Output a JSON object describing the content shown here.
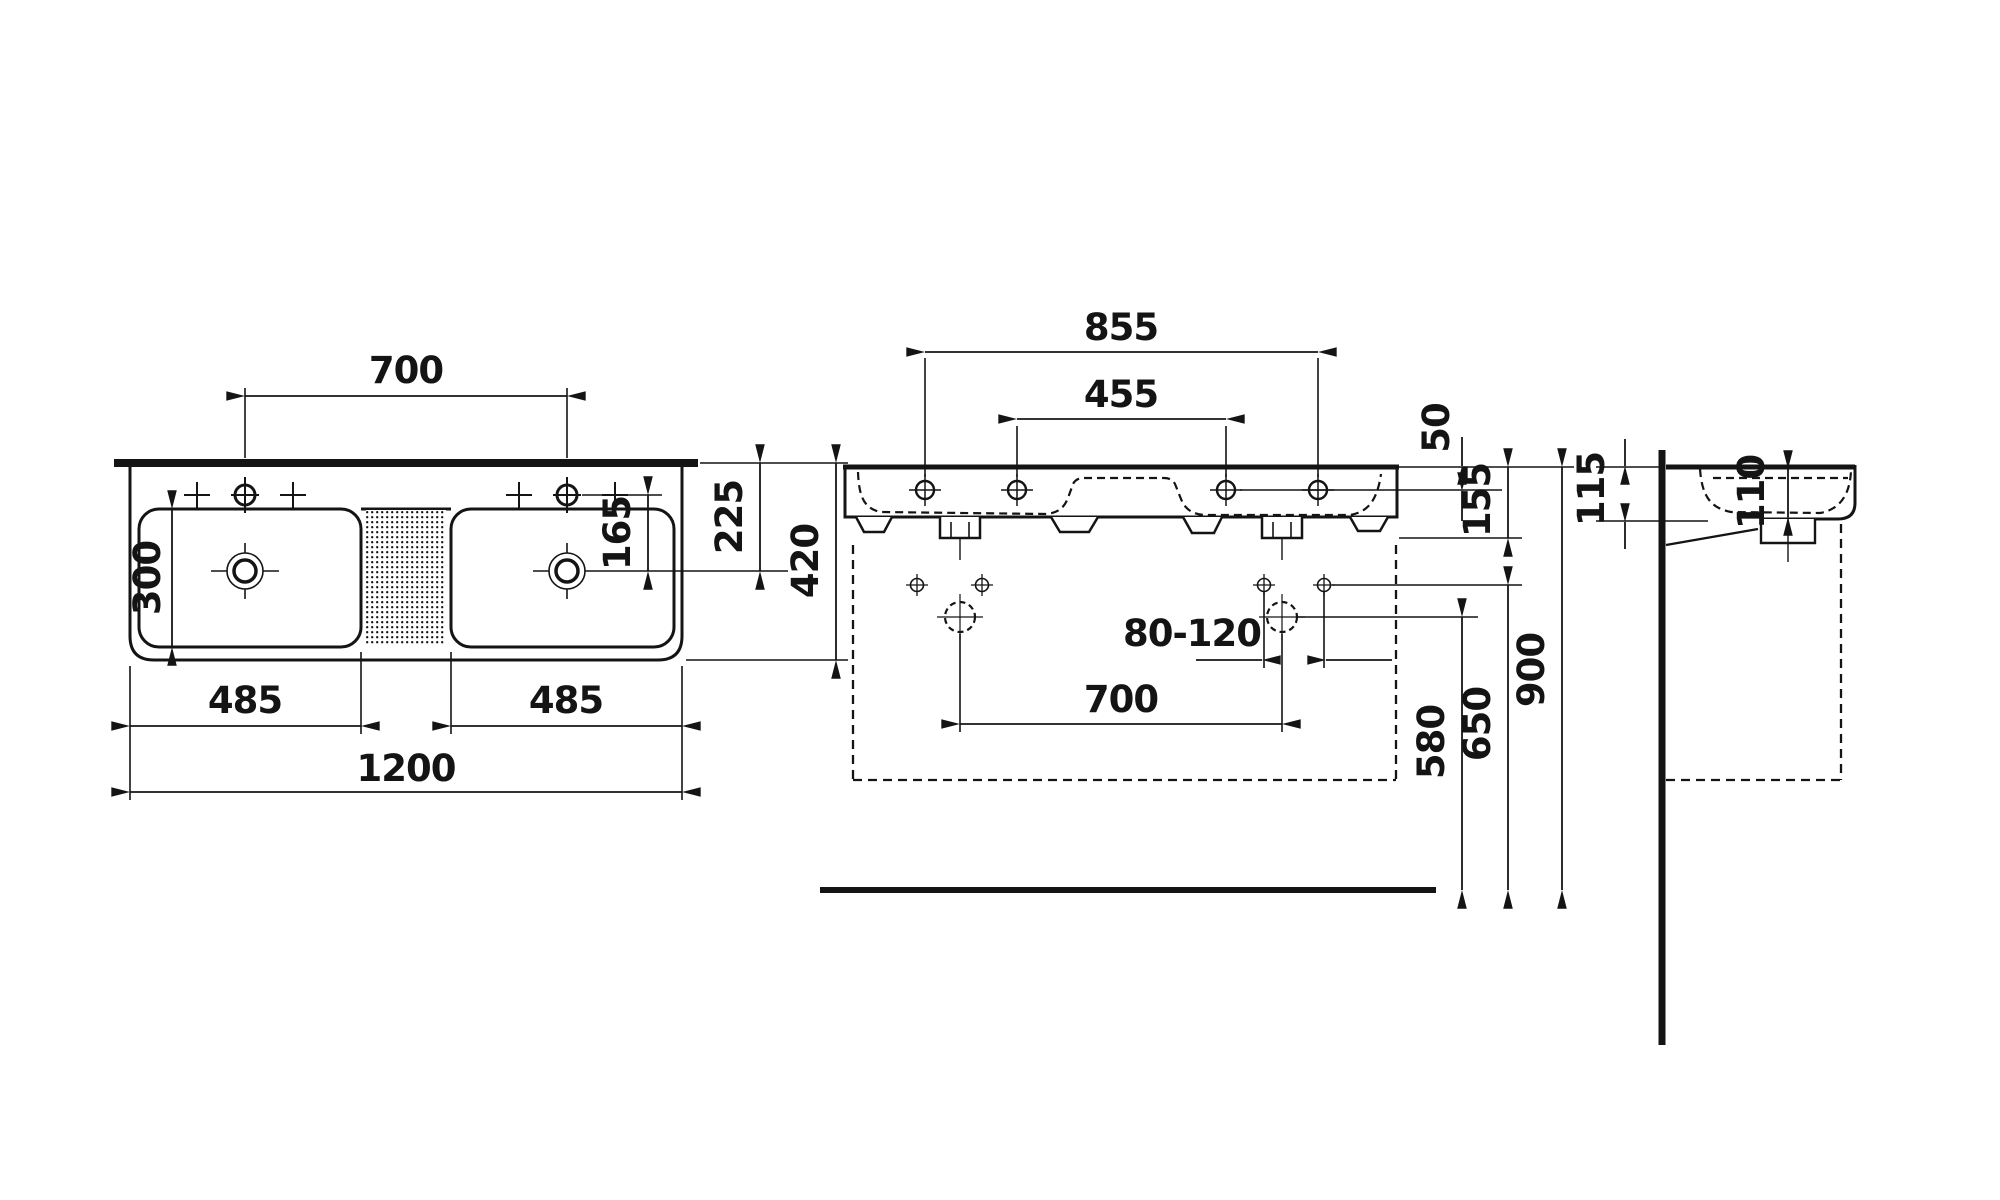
{
  "drawing": {
    "type": "technical-dimension-drawing",
    "subject": "double-washbasin",
    "views": [
      "top-view",
      "front-view",
      "side-view"
    ],
    "units": "mm"
  },
  "dims": {
    "top": {
      "tap_spacing": "700",
      "bowl_depth": "300",
      "tap_to_drain": "165",
      "edge_to_drain": "225",
      "total_depth": "420",
      "bowl_left_width": "485",
      "bowl_right_width": "485",
      "total_width": "1200"
    },
    "front": {
      "outer_hole_spacing": "855",
      "inner_hole_spacing": "455",
      "top_to_tap_line": "50",
      "apron_height": "155",
      "adjust_range": "80-120",
      "drain_spacing": "700",
      "drain_height": "580",
      "fixing_height": "650",
      "rim_height": "900"
    },
    "side": {
      "rim_edge_height": "115",
      "bowl_inner_depth": "110"
    }
  },
  "colors": {
    "ink": "#141414",
    "background": "#ffffff"
  }
}
